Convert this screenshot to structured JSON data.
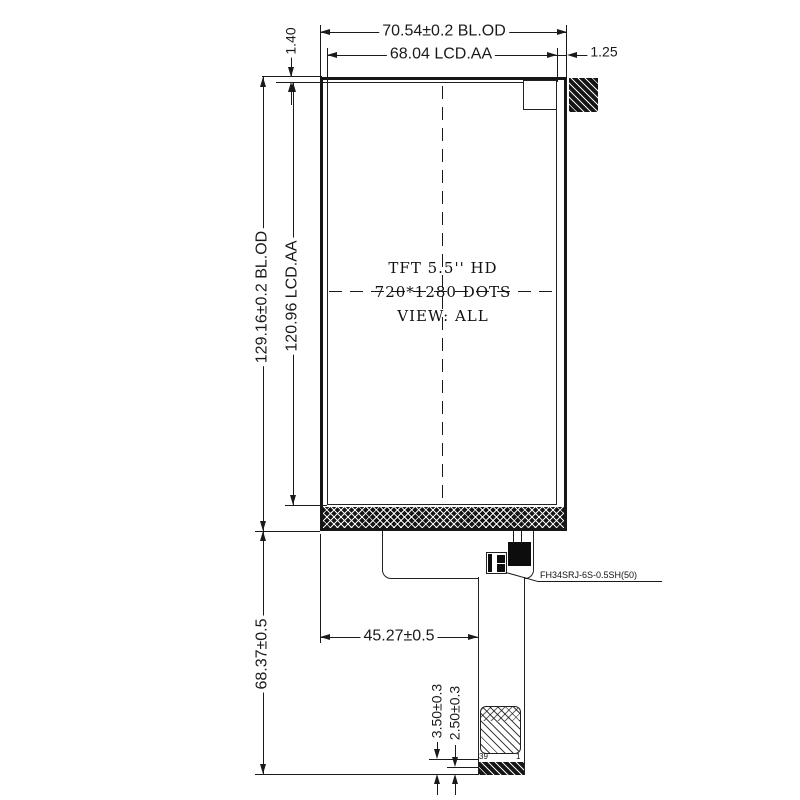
{
  "drawing": {
    "panel_text": [
      "TFT  5.5'' HD",
      "720*1280 DOTS",
      "VIEW: ALL"
    ],
    "dims": {
      "top_outer": "70.54±0.2 BL.OD",
      "top_inner": "68.04 LCD.AA",
      "right_offset": "1.25",
      "left_offset": "1.40",
      "side_outer": "129.16±0.2 BL.OD",
      "side_inner": "120.96 LCD.AA",
      "tail_length": "68.37±0.5",
      "tail_offset": "45.27±0.5",
      "contact_depth_a": "3.50±0.3",
      "contact_depth_b": "2.50±0.3"
    },
    "fpc": {
      "connector_label": "FH34SRJ-6S-0.5SH(50)",
      "pin_first": "39",
      "pin_last": "1"
    },
    "colors": {
      "line": "#1a1a1a",
      "background": "#ffffff",
      "fill_dark": "#151515"
    }
  }
}
